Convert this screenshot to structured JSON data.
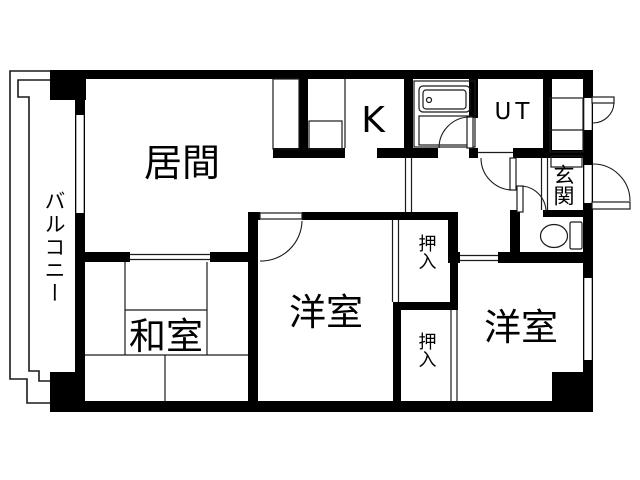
{
  "plan": {
    "type": "apartment-floor-plan",
    "labels": {
      "living": "居間",
      "kitchen": "K",
      "utility": "UT",
      "entrance": "玄関",
      "balcony": "バルコニー",
      "japanese_room": "和室",
      "western_room_1": "洋室",
      "western_room_2": "洋室",
      "closet_1": "押入",
      "closet_2": "押入"
    },
    "colors": {
      "wall": "#000000",
      "floor": "#ffffff",
      "outline": "#1a1a1a",
      "text": "#000000"
    }
  }
}
